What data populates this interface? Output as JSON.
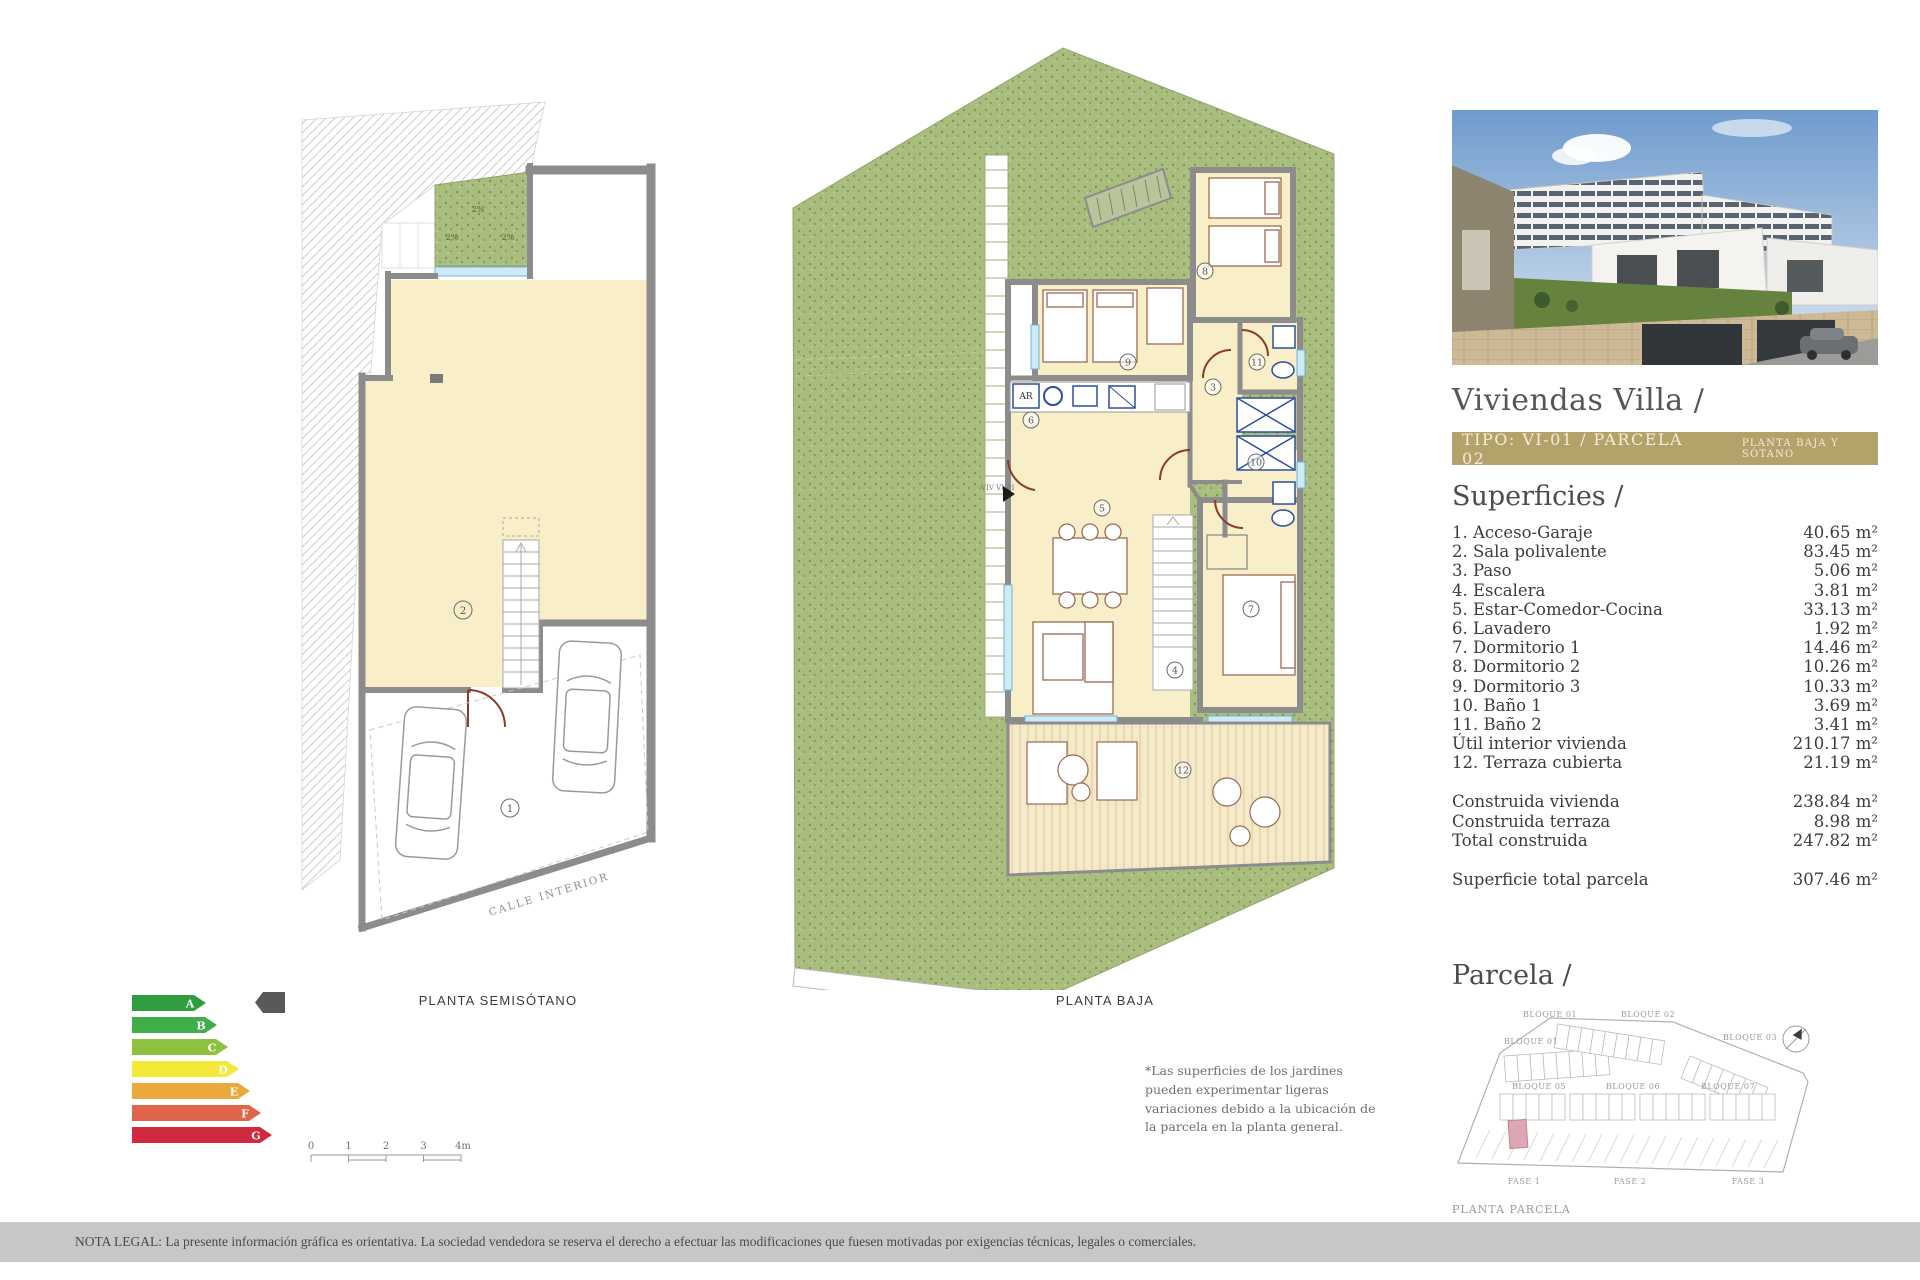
{
  "panel": {
    "title": "Viviendas Villa /",
    "tipo": {
      "main": "TIPO: VI-01 / PARCELA 02",
      "sub": "PLANTA BAJA Y SÓTANO"
    },
    "superficies": {
      "heading": "Superficies /",
      "items": [
        {
          "label": "1. Acceso-Garaje",
          "value": "40.65 m²"
        },
        {
          "label": "2. Sala polivalente",
          "value": "83.45 m²"
        },
        {
          "label": "3. Paso",
          "value": "5.06 m²"
        },
        {
          "label": "4. Escalera",
          "value": "3.81 m²"
        },
        {
          "label": "5. Estar-Comedor-Cocina",
          "value": "33.13 m²"
        },
        {
          "label": "6. Lavadero",
          "value": "1.92 m²"
        },
        {
          "label": "7. Dormitorio 1",
          "value": "14.46 m²"
        },
        {
          "label": "8. Dormitorio 2",
          "value": "10.26 m²"
        },
        {
          "label": "9. Dormitorio 3",
          "value": "10.33 m²"
        },
        {
          "label": "10. Baño 1",
          "value": "3.69 m²"
        },
        {
          "label": "11. Baño 2",
          "value": "3.41 m²"
        },
        {
          "label": "Útil interior vivienda",
          "value": "210.17 m²"
        },
        {
          "label": "12. Terraza cubierta",
          "value": "21.19 m²"
        }
      ],
      "totals": [
        {
          "label": "Construida vivienda",
          "value": "238.84 m²"
        },
        {
          "label": "Construida terraza",
          "value": "8.98 m²"
        },
        {
          "label": "Total construida",
          "value": "247.82 m²"
        }
      ],
      "parcel_total": {
        "label": "Superficie total parcela",
        "value": "307.46 m²"
      }
    },
    "parcela": {
      "heading": "Parcela /",
      "blocks": [
        "BLOQUE 01",
        "BLOQUE 02",
        "BLOQUE 03",
        "BLOQUE 01",
        "BLOQUE 05",
        "BLOQUE 06",
        "BLOQUE 07"
      ],
      "fases": [
        "FASE 1",
        "FASE 2",
        "FASE 3"
      ],
      "caption": "PLANTA PARCELA"
    }
  },
  "plans": {
    "semisotano": {
      "label": "PLANTA SEMISÓTANO",
      "street": "CALLE INTERIOR",
      "slope_marks": [
        "2%",
        "2%",
        "2%"
      ],
      "rooms": {
        "r1": "1",
        "r2": "2"
      }
    },
    "baja": {
      "label": "PLANTA BAJA",
      "entry": "VIV VI-01",
      "ar": "AR",
      "rooms": {
        "r3": "3",
        "r4": "4",
        "r5": "5",
        "r6": "6",
        "r7": "7",
        "r8": "8",
        "r9": "9",
        "r10": "10",
        "r11": "11",
        "r12": "12"
      }
    }
  },
  "energy": {
    "ratings": [
      {
        "letter": "A",
        "color": "#2e9e41"
      },
      {
        "letter": "B",
        "color": "#3fae49"
      },
      {
        "letter": "C",
        "color": "#8cc23f"
      },
      {
        "letter": "D",
        "color": "#f2e93b"
      },
      {
        "letter": "E",
        "color": "#eba83e"
      },
      {
        "letter": "F",
        "color": "#e06449"
      },
      {
        "letter": "G",
        "color": "#cf2a3f"
      }
    ],
    "pointer_color": "#58595b"
  },
  "scalebar": {
    "ticks": [
      "0",
      "1",
      "2",
      "3",
      "4m"
    ]
  },
  "note": "*Las superficies de los jardines pueden experimentar ligeras variaciones debido a la ubicación de la parcela en la planta general.",
  "legal": "NOTA LEGAL: La presente información gráfica es orientativa. La sociedad vendedora se reserva el derecho a efectuar las modificaciones que fuesen motivadas por exigencias técnicas, legales o comerciales.",
  "colors": {
    "gold": "#b3a269",
    "floor_cream": "#f8eec8",
    "garden_green": "#a9bd7f",
    "wall_gray": "#8c8c8c"
  }
}
